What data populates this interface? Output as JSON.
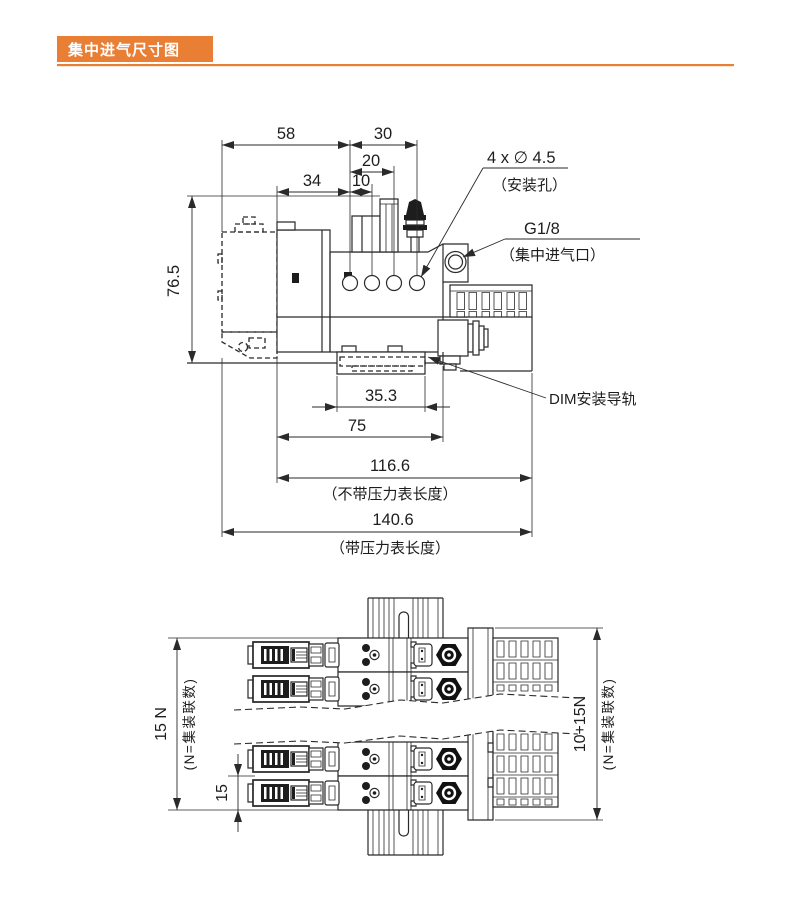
{
  "title": "集中进气尺寸图",
  "colors": {
    "accent": "#E97E35",
    "accent_light": "#F5C9A5",
    "ink": "#2A2A2A"
  },
  "side_view": {
    "dim_58": "58",
    "dim_30": "30",
    "dim_20": "20",
    "dim_10": "10",
    "dim_34": "34",
    "dim_height": "76.5",
    "dim_rail_width": "35.3",
    "dim_75": "75",
    "dim_body_length": "116.6",
    "note_without_gauge": "（不带压力表长度）",
    "dim_overall_length": "140.6",
    "note_with_gauge": "（带压力表长度）",
    "callout_hole": "4 x ∅ 4.5",
    "callout_hole_note": "（安装孔）",
    "callout_port": "G1/8",
    "callout_port_note": "（集中进气口）",
    "callout_din_rail": "DIM安装导轨"
  },
  "plan_view": {
    "dim_stations_total": "15 N",
    "note_stations_total": "(N=集装联数)",
    "dim_station_pitch": "15",
    "dim_overall": "10+15N",
    "note_overall": "(N=集装联数)"
  }
}
